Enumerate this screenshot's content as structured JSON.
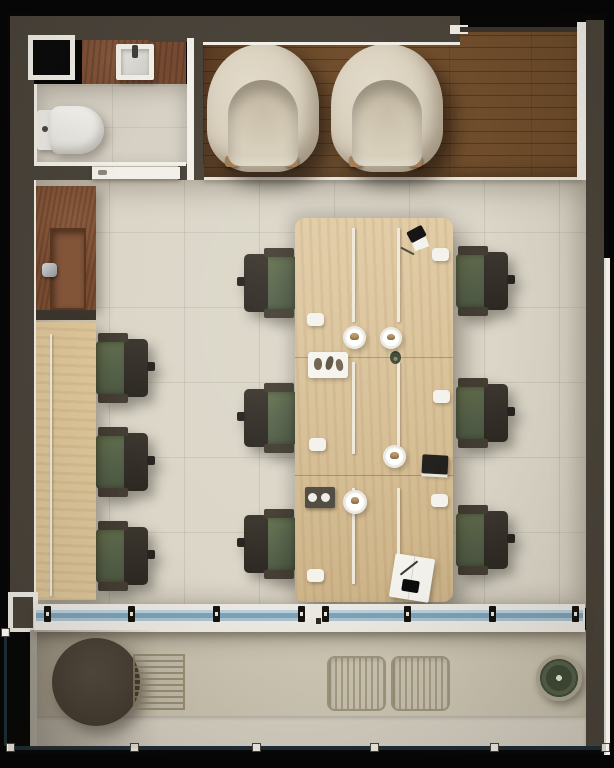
{
  "meta": {
    "title": "Top-view architectural render of a small office suite with bathroom, lounge, open workspace and terrace"
  },
  "palette": {
    "wall": "#49433a",
    "trim_white": "#f1efe8",
    "office_floor": "#dbd6c8",
    "bathroom_floor": "#d6d1c4",
    "lounge_wood_floor": "#6e4d2e",
    "desk_wood": "#d9c094",
    "sideboard_wood": "#7a4c31",
    "chair_green": "#5a674c",
    "chair_frame": "#36322b",
    "armchair_boucle": "#d9d0bf",
    "facade_glass": "#8fb3c9",
    "terrace_concrete": "#c9c2af",
    "railing": "#1d2b35"
  },
  "rooms": [
    {
      "name": "bathroom",
      "location": "top-left",
      "items": [
        "wall niche",
        "vanity counter with washbasin and faucet",
        "toilet",
        "white door"
      ]
    },
    {
      "name": "lounge",
      "location": "top",
      "flooring": "dark wood planks",
      "items": [
        "boucle armchair",
        "boucle armchair"
      ]
    },
    {
      "name": "open-workspace",
      "location": "center",
      "flooring": "beige tile",
      "items": [
        "timber sideboard with inset sink and faucet",
        "wall desk with 3 workstations",
        "central bench desk with 6 workstations",
        "9 green task chairs",
        "desk privacy screens"
      ]
    },
    {
      "name": "terrace",
      "location": "bottom",
      "flooring": "concrete",
      "items": [
        "round ottoman",
        "timber slat mat",
        "floor grille",
        "floor grille",
        "potted plant",
        "glass balustrade"
      ]
    }
  ],
  "equipment_per_workstation": [
    "monitor",
    "keyboard",
    "mouse"
  ],
  "table_accessories": [
    "coffee cups",
    "serving plates with pastry",
    "pastry tray",
    "dark tray with two cups",
    "stack of books",
    "open notebook with pen",
    "smartphone",
    "smartphone with card",
    "small plant"
  ],
  "counts": {
    "workstations": 9,
    "task_chairs": 9,
    "armchairs": 2,
    "facade_glass_clips": 8,
    "balustrade_posts": 6
  }
}
